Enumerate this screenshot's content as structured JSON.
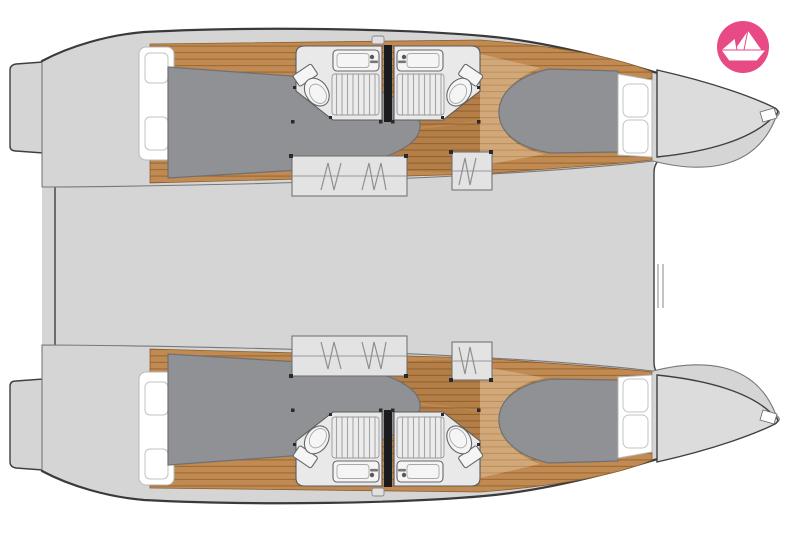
{
  "page": {
    "background": "#ffffff"
  },
  "logo": {
    "icon": "paper-boat-icon",
    "shape": "circle",
    "background_color": "#e84a86",
    "boat_color": "#ffffff"
  },
  "palette": {
    "deck": "#d5d5d6",
    "deck_light": "#dcdcdd",
    "steps_fill": "#e3e3e4",
    "outline": "#3f3f41",
    "inner_line": "#77787a",
    "wood": "#c08a52",
    "wood_line": "#9d6a33",
    "bed": "#8f9194",
    "bed_outline": "#6e7073",
    "room_floor": "#e9e9ea",
    "fixture_line": "#66676a",
    "panel": "#ffffff",
    "divider": "#1b1b1d",
    "logo_pink": "#e84a86"
  },
  "plan": {
    "vessel_type": "catamaran-floor-plan",
    "orientation": "bow-right",
    "symmetry": "two-mirrored-hulls",
    "regions": [
      "stern-platform",
      "aft-cabin-berth",
      "aft-head-shower-toilet-sink",
      "companionway-stairs",
      "fwd-head-shower-toilet-sink",
      "fwd-cabin-berth",
      "bow-foredeck",
      "main-deck",
      "foredeck-trampoline"
    ]
  }
}
